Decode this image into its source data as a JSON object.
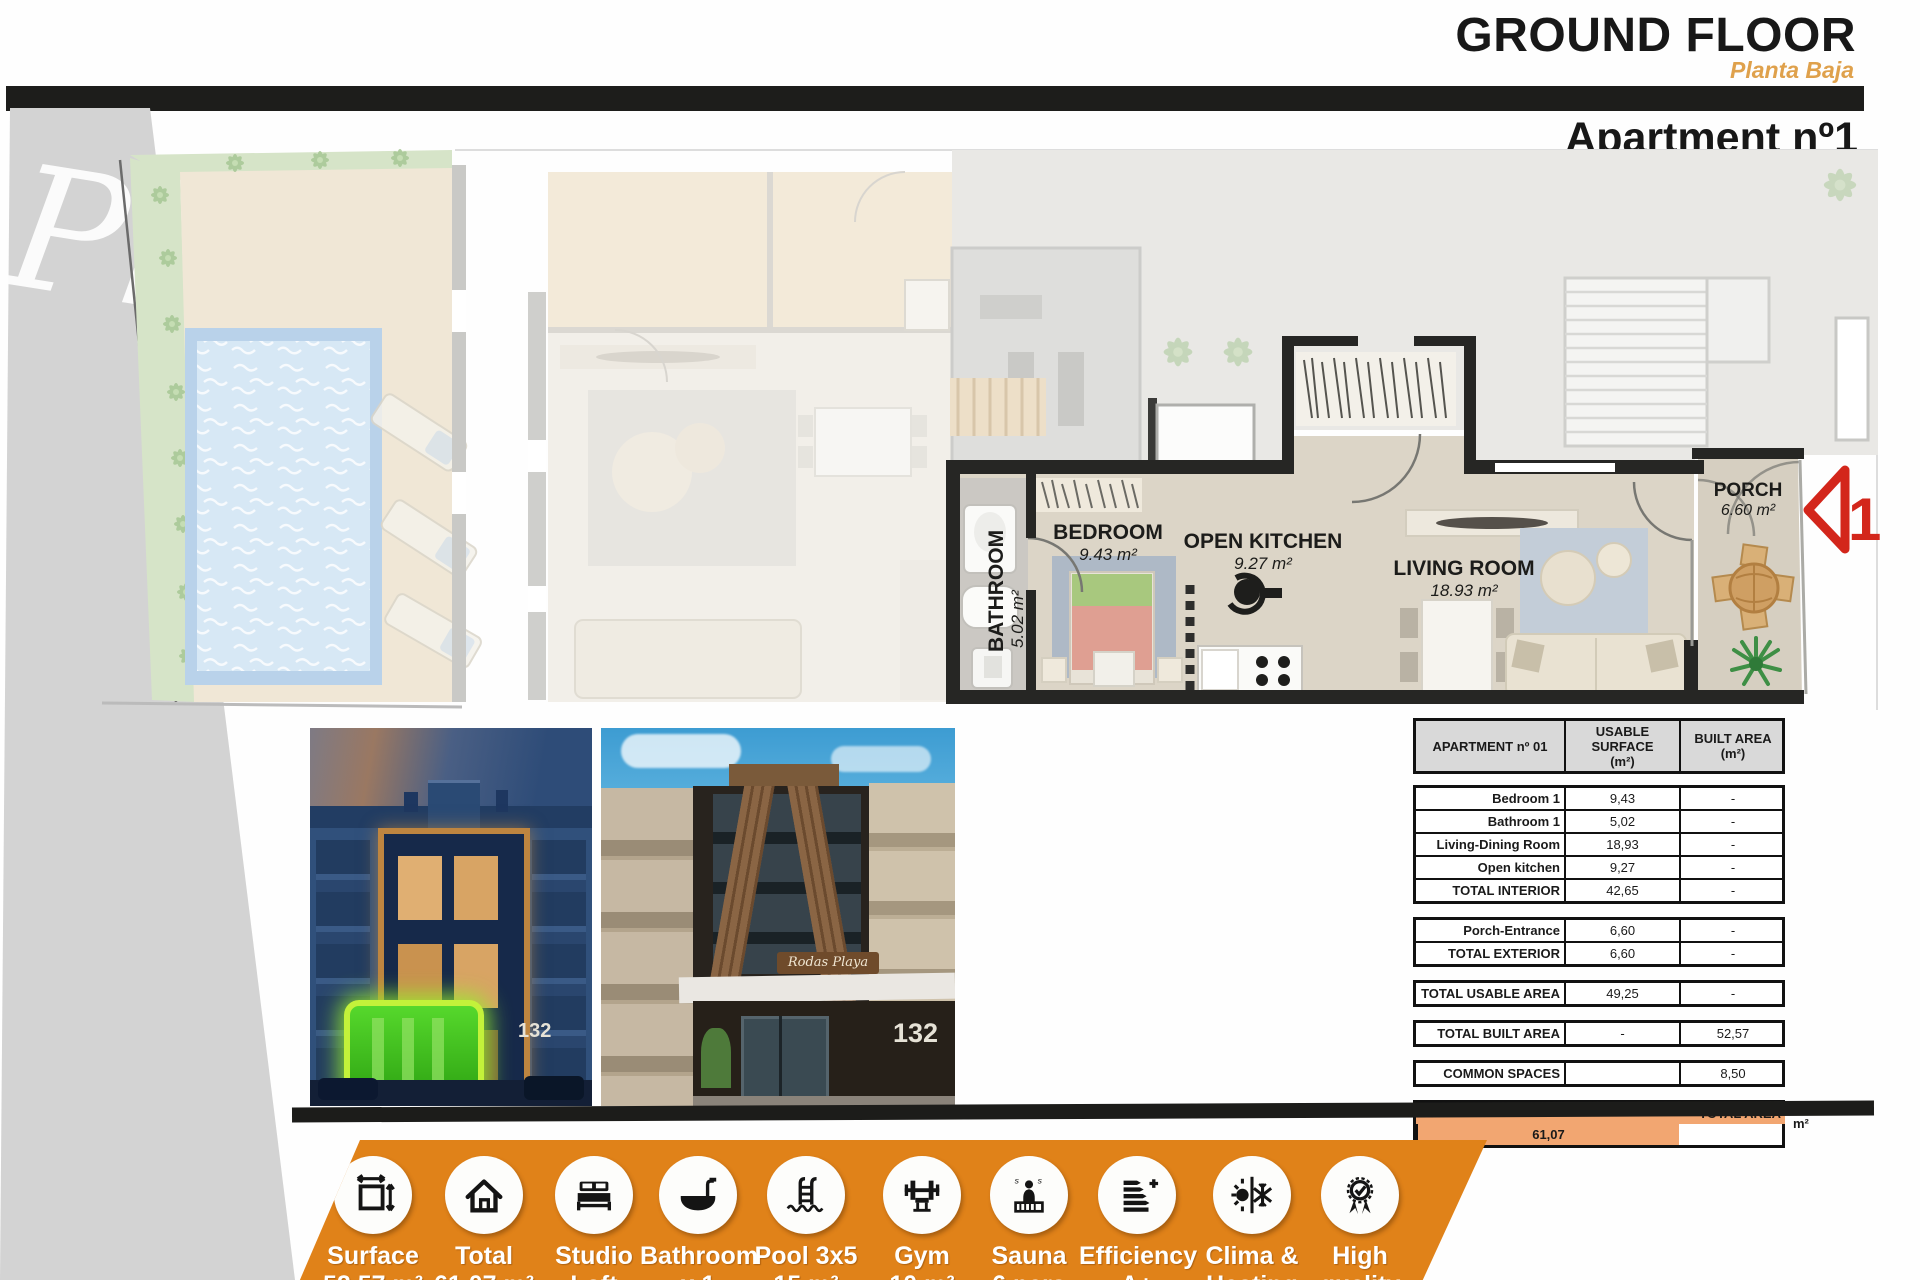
{
  "header": {
    "title": "GROUND FLOOR",
    "subtitle": "Planta Baja",
    "apartment_title": "Apartment nº1",
    "apartment_subtitle": "Apartamento nº 1"
  },
  "watermark": "Pl",
  "colors": {
    "accent_orange": "#E08219",
    "subtitle_orange": "#DFA14C",
    "table_total_orange": "#F2A671",
    "marker_red": "#D3261B",
    "highlight_green": "#49D41D",
    "pool_blue": "#D7E8F5"
  },
  "plan": {
    "rooms": [
      {
        "id": "bathroom",
        "name": "BATHROOM",
        "area": "5.02 m²"
      },
      {
        "id": "bedroom",
        "name": "BEDROOM",
        "area": "9.43 m²"
      },
      {
        "id": "open-kitchen",
        "name": "OPEN KITCHEN",
        "area": "9.27 m²"
      },
      {
        "id": "living-room",
        "name": "LIVING ROOM",
        "area": "18.93 m²"
      },
      {
        "id": "porch",
        "name": "PORCH",
        "area": "6.60 m²"
      }
    ],
    "unit_marker": "1"
  },
  "photos": {
    "night": {
      "building_number": "132"
    },
    "day": {
      "sign": "Rodas Playa",
      "building_number": "132"
    }
  },
  "table": {
    "headers": [
      {
        "line1": "APARTMENT nº 01",
        "line2": ""
      },
      {
        "line1": "USABLE SURFACE",
        "line2": "(m²)"
      },
      {
        "line1": "BUILT AREA",
        "line2": "(m²)"
      }
    ],
    "groups": [
      {
        "rows": [
          {
            "label": "Bedroom 1",
            "usable": "9,43",
            "built": "-"
          },
          {
            "label": "Bathroom 1",
            "usable": "5,02",
            "built": "-"
          },
          {
            "label": "Living-Dining Room",
            "usable": "18,93",
            "built": "-"
          },
          {
            "label": "Open kitchen",
            "usable": "9,27",
            "built": "-"
          },
          {
            "label": "TOTAL INTERIOR",
            "usable": "42,65",
            "built": "-"
          }
        ]
      },
      {
        "rows": [
          {
            "label": "Porch-Entrance",
            "usable": "6,60",
            "built": "-"
          },
          {
            "label": "TOTAL EXTERIOR",
            "usable": "6,60",
            "built": "-"
          }
        ]
      },
      {
        "rows": [
          {
            "label": "TOTAL USABLE AREA",
            "usable": "49,25",
            "built": "-"
          }
        ]
      },
      {
        "rows": [
          {
            "label": "TOTAL BUILT AREA",
            "usable": "-",
            "built": "52,57"
          }
        ]
      },
      {
        "rows": [
          {
            "label": "COMMON SPACES",
            "usable": "",
            "built": "8,50"
          }
        ]
      }
    ],
    "total_row": {
      "label": "TOTAL AREA",
      "value": "61,07",
      "unit": "m²"
    }
  },
  "features": [
    {
      "icon": "surface-measure-icon",
      "line1": "Surface",
      "line2": "52,57 m²"
    },
    {
      "icon": "house-icon",
      "line1": "Total",
      "line2": "61,07 m²"
    },
    {
      "icon": "bed-icon",
      "line1": "Studio",
      "line2": "Loft"
    },
    {
      "icon": "bathtub-icon",
      "line1": "Bathroom",
      "line2": "x 1"
    },
    {
      "icon": "pool-ladder-icon",
      "line1": "Pool 3x5",
      "line2": "15 m²"
    },
    {
      "icon": "gym-icon",
      "line1": "Gym",
      "line2": "10 m²"
    },
    {
      "icon": "sauna-icon",
      "line1": "Sauna",
      "line2": "6 pers"
    },
    {
      "icon": "efficiency-icon",
      "line1": "Efficiency",
      "line2": "A+"
    },
    {
      "icon": "clima-icon",
      "line1": "Clima &",
      "line2": "Heating"
    },
    {
      "icon": "quality-icon",
      "line1": "High",
      "line2": "quality"
    }
  ]
}
